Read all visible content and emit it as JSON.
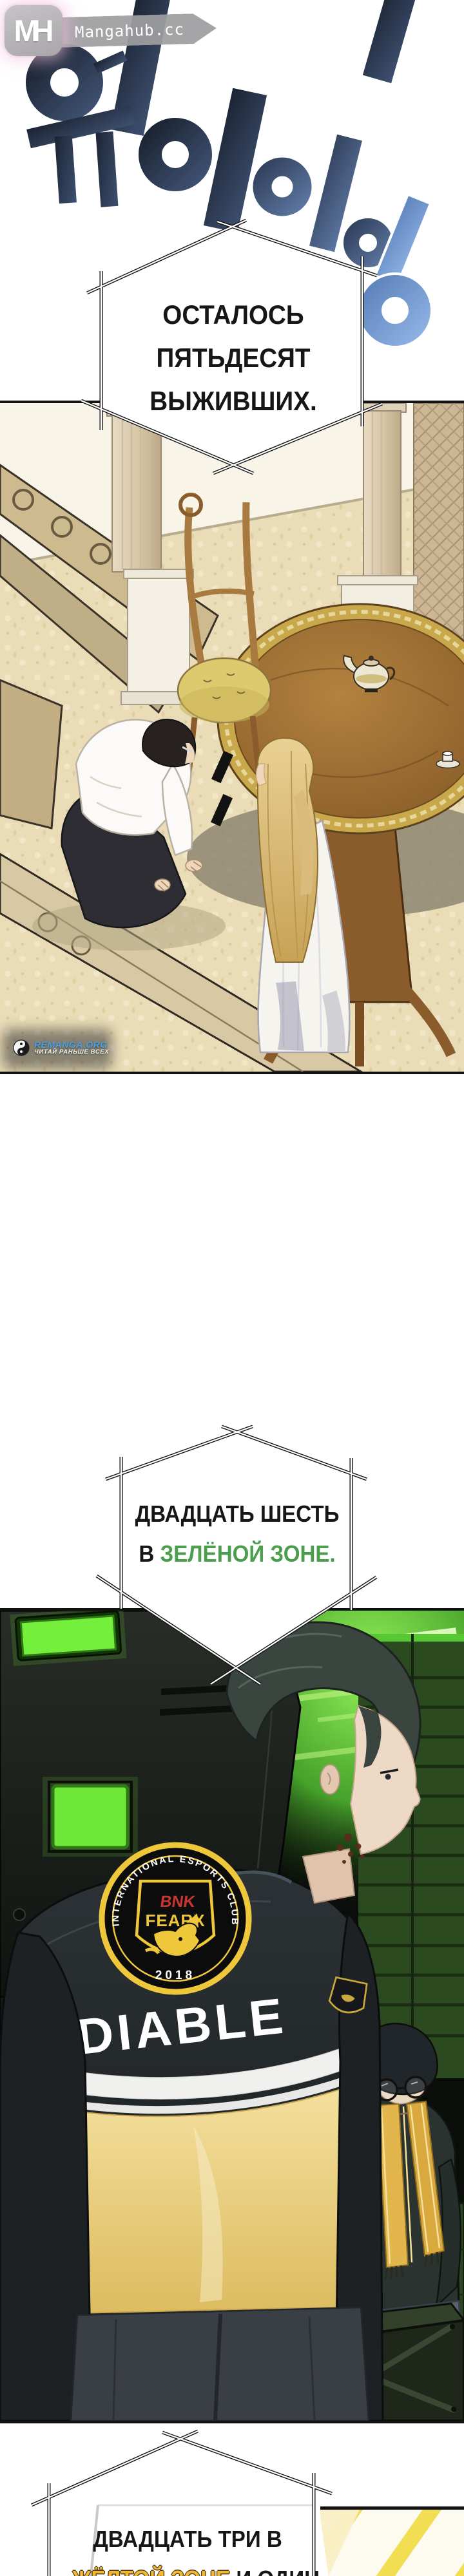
{
  "site": {
    "logo_initials": "MH",
    "name": "Mangahub.cc"
  },
  "sfx": {
    "korean_text": "워이이이이",
    "navy_color": "#2e3d58",
    "blue_color": "#7ba1da"
  },
  "captions": {
    "one": {
      "lines": [
        "ОСТАЛОСЬ",
        "ПЯТЬДЕСЯТ",
        "ВЫЖИВШИХ."
      ]
    },
    "two": {
      "line1": "ДВАДЦАТЬ ШЕСТЬ",
      "line2_prefix": "В",
      "line2_highlight": "ЗЕЛЁНОЙ ЗОНЕ.",
      "highlight_color": "#4a9e4c"
    },
    "three": {
      "line1": "ДВАДЦАТЬ ТРИ В",
      "line2_highlight": "ЖЁЛТОЙ ЗОНЕ",
      "line2_suffix": "И ОДИН",
      "highlight_color": "#f0b93a"
    }
  },
  "watermark": {
    "site": "REMANGA.ORG",
    "tagline": "ЧИТАЙ РАНЬШЕ ВСЕХ",
    "accent_color": "#4aa0e8",
    "icon": "yin-yang"
  },
  "panel2": {
    "emblem_arc": "INTERNATIONAL ESPORTS CLUB",
    "emblem_year": "2018",
    "emblem_team_line1": "BNK",
    "emblem_team_line2": "FEARX",
    "jacket_back_text": "DIABLE"
  }
}
